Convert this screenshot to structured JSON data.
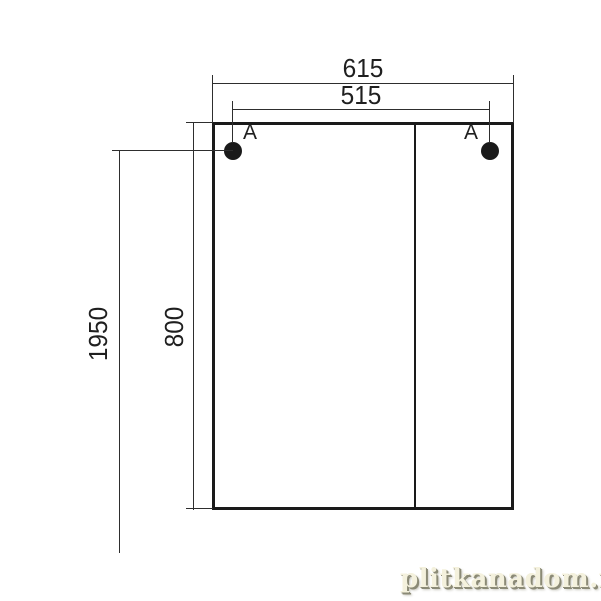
{
  "drawing": {
    "dimensions": {
      "total_width": "615",
      "hole_spacing_width": "515",
      "mounting_height": "1950",
      "cabinet_height": "800"
    },
    "mount_points": {
      "left_label": "A",
      "right_label": "A"
    },
    "colors": {
      "outline": "#1a1a1a",
      "thin_line": "#2e2e2e",
      "background": "#ffffff",
      "watermark_fill": "#f4f1dd",
      "watermark_shadow": "#8b8a76"
    }
  },
  "watermark": {
    "text": "plitkanadom.ru"
  }
}
